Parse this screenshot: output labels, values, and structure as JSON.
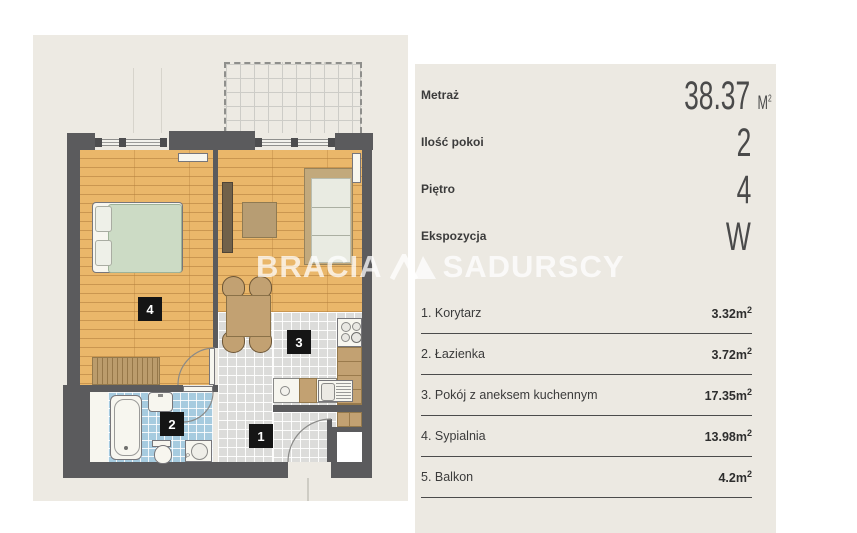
{
  "brand": {
    "left": "BRACIA",
    "right": "SADURSCY"
  },
  "panel": {
    "metrics": [
      {
        "label": "Metraż",
        "value": "38.37",
        "unit_base": "M",
        "unit_sup": "2"
      },
      {
        "label": "Ilość pokoi",
        "value": "2"
      },
      {
        "label": "Piętro",
        "value": "4"
      },
      {
        "label": "Ekspozycja",
        "value": "W"
      }
    ],
    "rooms": [
      {
        "title": "1. Korytarz",
        "area": "3.32",
        "unit": "m",
        "sup": "2"
      },
      {
        "title": "2. Łazienka",
        "area": "3.72",
        "unit": "m",
        "sup": "2"
      },
      {
        "title": "3. Pokój z aneksem kuchennym",
        "area": "17.35",
        "unit": "m",
        "sup": "2"
      },
      {
        "title": "4. Sypialnia",
        "area": "13.98",
        "unit": "m",
        "sup": "2"
      },
      {
        "title": "5. Balkon",
        "area": "4.2",
        "unit": "m",
        "sup": "2"
      }
    ]
  },
  "plan": {
    "room_labels": {
      "corridor": "1",
      "bathroom": "2",
      "living": "3",
      "bedroom": "4"
    },
    "washer_label": "P",
    "colors": {
      "wall": "#5b5b5d",
      "wood_floor": "#eab76a",
      "gray_tile": "#dcdcda",
      "blue_tile": "#a6cbdf",
      "furniture_brown": "#c2a172",
      "duvet_green": "#ccdbc5",
      "background_beige": "#edeae3",
      "label_bg": "#151515"
    }
  }
}
